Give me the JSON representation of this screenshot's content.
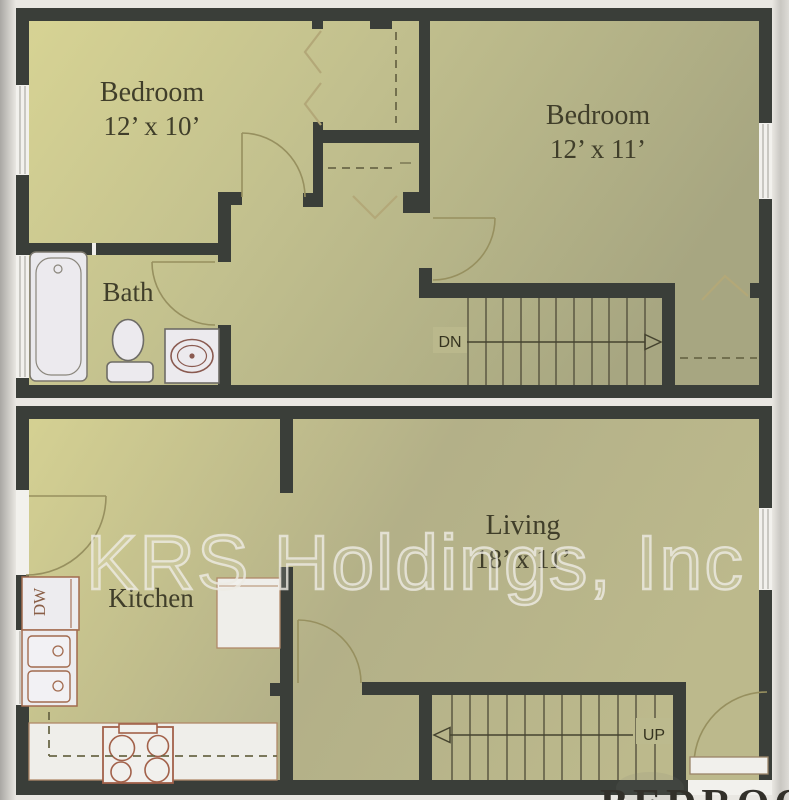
{
  "document": {
    "type": "apartment-floor-plan",
    "levels": [
      "upper",
      "lower"
    ]
  },
  "watermark": {
    "text": "KRS Holdings, Inc"
  },
  "upper_floor": {
    "rooms": [
      {
        "name": "Bedroom",
        "dims": "12’ x 10’"
      },
      {
        "name": "Bedroom",
        "dims": "12’ x 11’"
      },
      {
        "name": "Bath",
        "dims": ""
      }
    ],
    "stairs_label": "DN",
    "fixtures": [
      "bathtub",
      "toilet",
      "sink",
      "closet-bifold-doors",
      "closet-rod-dashed"
    ]
  },
  "lower_floor": {
    "rooms": [
      {
        "name": "Kitchen",
        "dims": ""
      },
      {
        "name": "Living",
        "dims": "18’ x 11’"
      }
    ],
    "stairs_label": "UP",
    "dishwasher_label": "DW",
    "fixtures": [
      "dishwasher",
      "double-sink",
      "range-stove",
      "counters",
      "upper-cabinets-dashed",
      "entry-door",
      "front-door"
    ]
  },
  "bottom_caption_fragment": "BEDROO",
  "colors": {
    "floor_fill_light": "#d8d494",
    "floor_fill_dark": "#a7a681",
    "wall_fill": "#3a3e39",
    "fixture_fill": "#eeedf0",
    "fixture_outline_brown": "#a26b4f",
    "counter_outline": "#b08968",
    "door_swing": "#97905f",
    "label_color": "#403e2a",
    "watermark_color": "#edebe4",
    "page_background": "#e9e7e2"
  }
}
